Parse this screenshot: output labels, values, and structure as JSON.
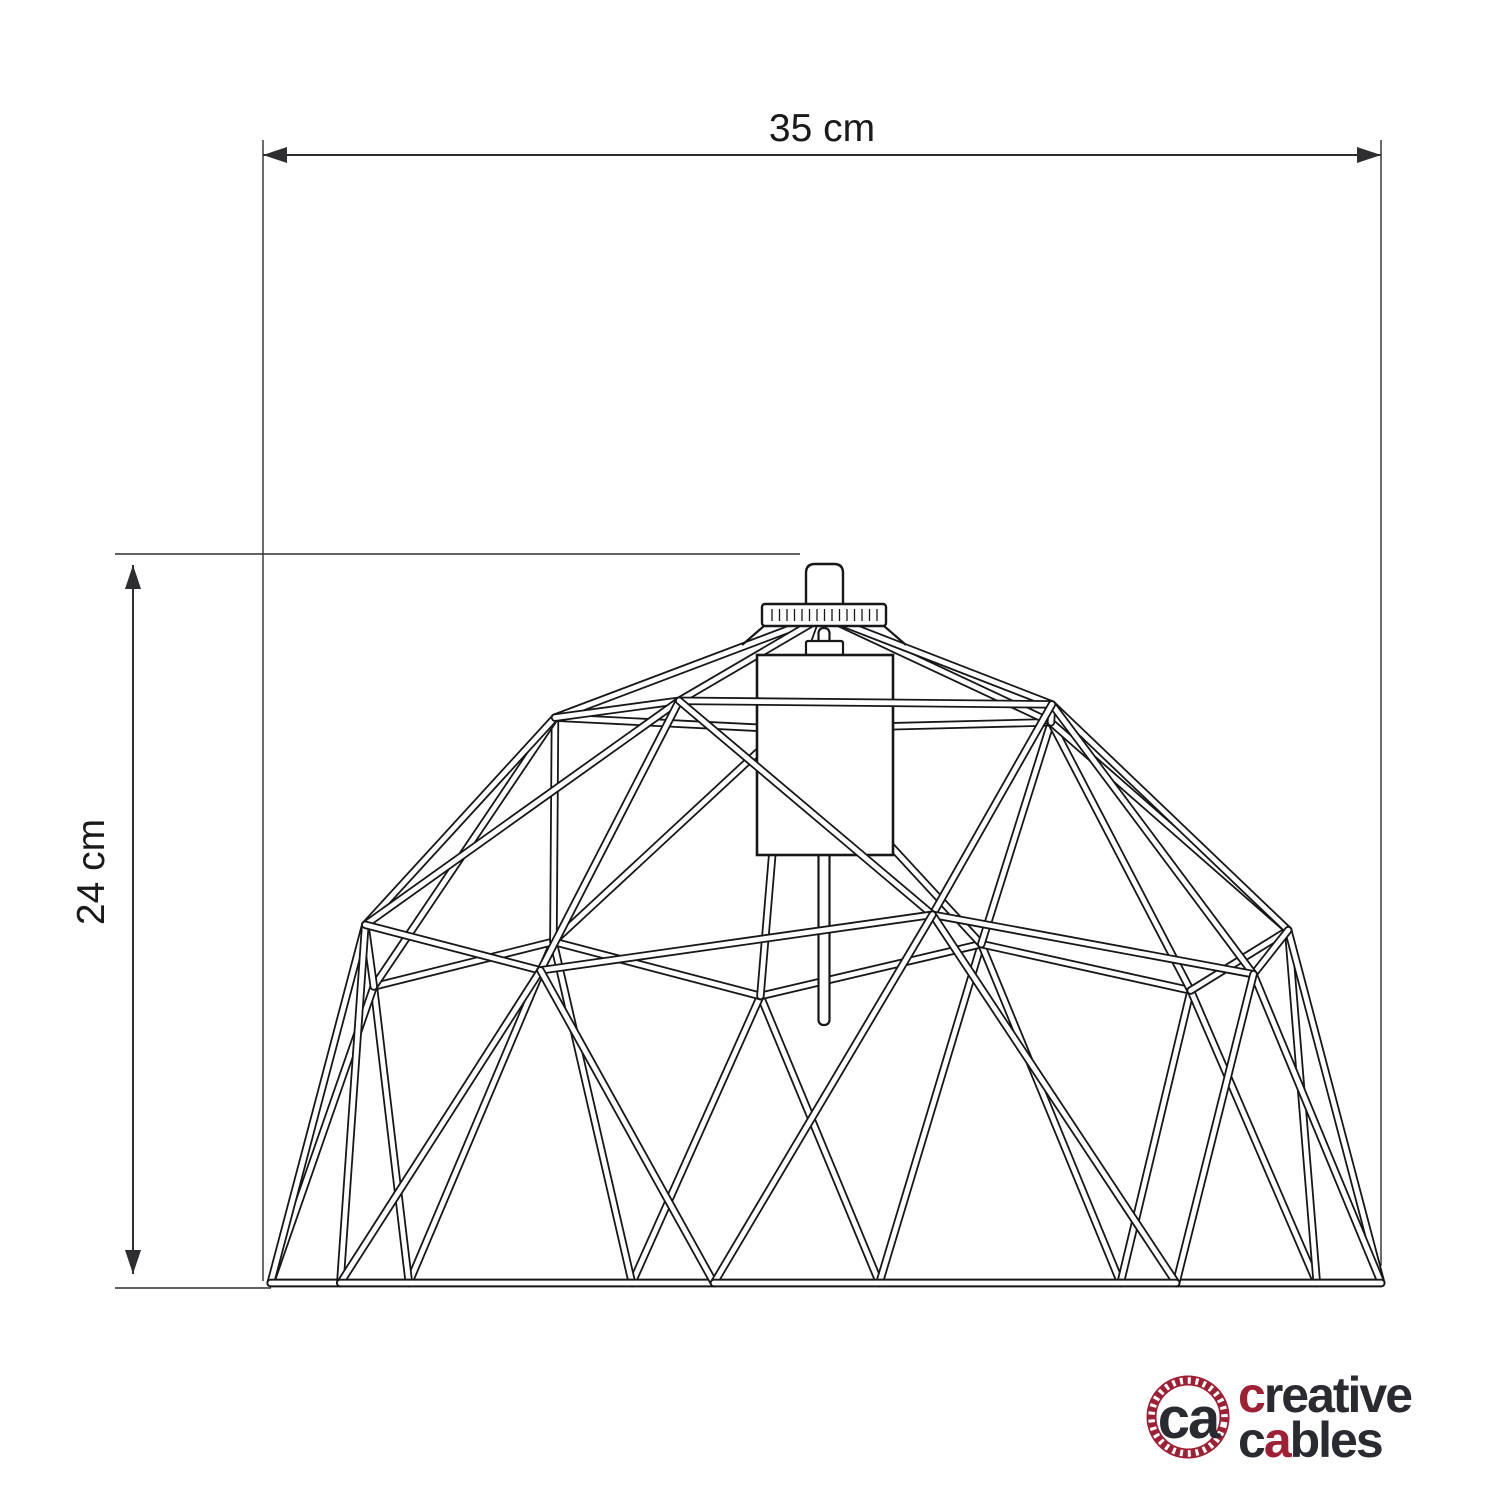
{
  "dimensions": {
    "width": {
      "label": "35 cm"
    },
    "height": {
      "label": "24 cm"
    }
  },
  "logo": {
    "monogram": "ca",
    "line1_c": "c",
    "line1_rest": "reative",
    "line2_c": "c",
    "line2_a": "a",
    "line2_rest": "bles"
  },
  "drawing": {
    "line_color": "#17171a",
    "dimension_color": "#2e2e30",
    "dimension_text_color": "#1a1a1d",
    "background": "#ffffff",
    "logo_red": "#9e2034",
    "logo_dark": "#2a2a31"
  }
}
